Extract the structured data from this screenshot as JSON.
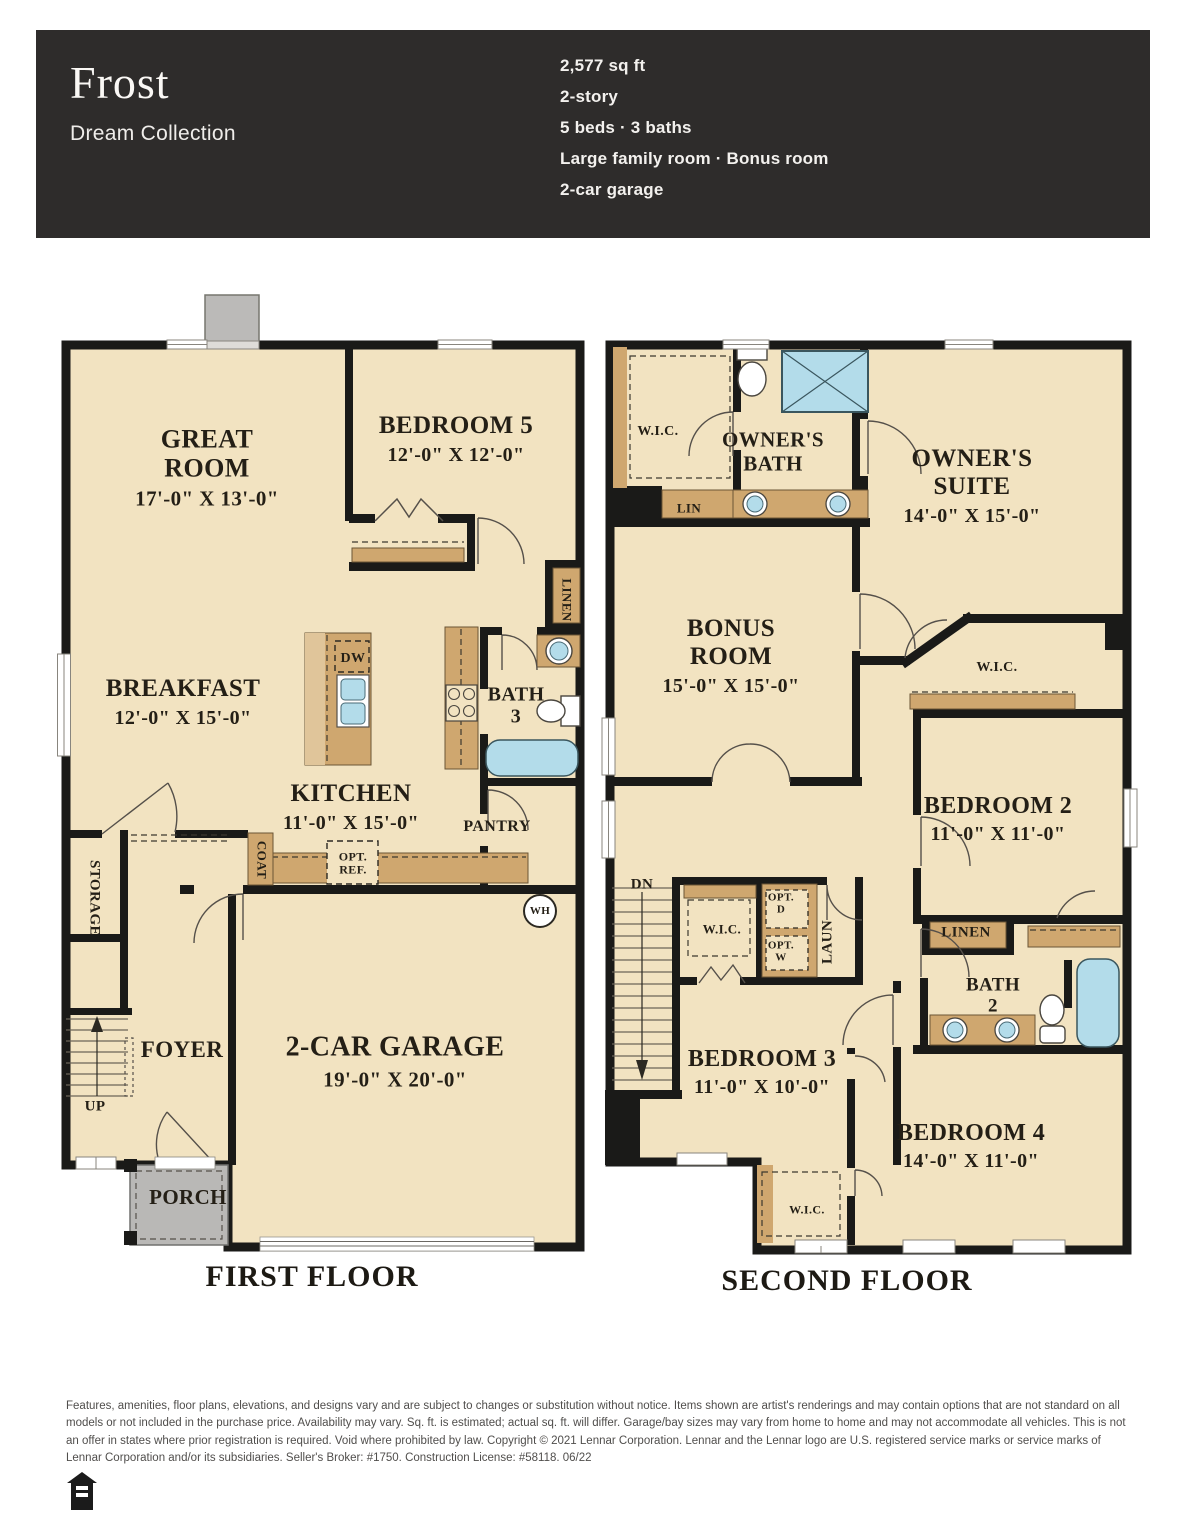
{
  "header": {
    "title": "Frost",
    "collection": "Dream Collection",
    "specs": [
      "2,577 sq ft",
      "2-story",
      "5 beds · 3 baths",
      "Large family room · Bonus room",
      "2-car garage"
    ]
  },
  "floor1": {
    "caption": "FIRST FLOOR",
    "great_room_name": "GREAT\nROOM",
    "great_room_dims": "17'-0\" X 13'-0\"",
    "bedroom5_name": "BEDROOM 5",
    "bedroom5_dims": "12'-0\" X 12'-0\"",
    "breakfast_name": "BREAKFAST",
    "breakfast_dims": "12'-0\" X 15'-0\"",
    "kitchen_name": "KITCHEN",
    "kitchen_dims": "11'-0\" X 15'-0\"",
    "bath3": "BATH\n3",
    "pantry": "PANTRY",
    "linen": "LINEN",
    "coat": "COAT",
    "storage": "STORAGE",
    "opt_ref": "OPT.\nREF.",
    "dw": "DW",
    "wh": "WH",
    "foyer": "FOYER",
    "up": "UP",
    "garage_name": "2-CAR GARAGE",
    "garage_dims": "19'-0\" X 20'-0\"",
    "porch": "PORCH"
  },
  "floor2": {
    "caption": "SECOND FLOOR",
    "wic": "W.I.C.",
    "owners_bath": "OWNER'S\nBATH",
    "owners_suite_name": "OWNER'S\nSUITE",
    "owners_suite_dims": "14'-0\" X 15'-0\"",
    "lin": "LIN",
    "bonus_name": "BONUS\nROOM",
    "bonus_dims": "15'-0\" X 15'-0\"",
    "bedroom2_name": "BEDROOM 2",
    "bedroom2_dims": "11'-0\" X 11'-0\"",
    "bedroom3_name": "BEDROOM 3",
    "bedroom3_dims": "11'-0\" X 10'-0\"",
    "bedroom4_name": "BEDROOM 4",
    "bedroom4_dims": "14'-0\" X 11'-0\"",
    "bath2": "BATH\n2",
    "linen": "LINEN",
    "laun": "LAUN",
    "opt_d": "OPT.\nD",
    "opt_w": "OPT.\nW",
    "dn": "DN"
  },
  "footer": {
    "disclaimer": "Features, amenities, floor plans, elevations, and designs vary and are subject to changes or substitution without notice. Items shown are artist's renderings and may contain options that are not standard on all models or not included in the purchase price. Availability may vary. Sq. ft. is estimated; actual sq. ft. will differ. Garage/bay sizes may vary from home to home and may not accommodate all vehicles. This is not an offer in states where prior registration is required. Void where prohibited by law. Copyright © 2021 Lennar Corporation. Lennar and the Lennar logo are U.S. registered service marks or service marks of Lennar Corporation and/or its subsidiaries. Seller's Broker: #1750. Construction License: #58118. 06/22"
  },
  "colors": {
    "header_bg": "#2e2c2b",
    "floor_fill": "#f2e3c1",
    "cabinet_tan": "#cfa76f",
    "fixture_blue": "#b3dcea",
    "porch_gray": "#b9b8b6",
    "wall": "#1a1a18"
  }
}
